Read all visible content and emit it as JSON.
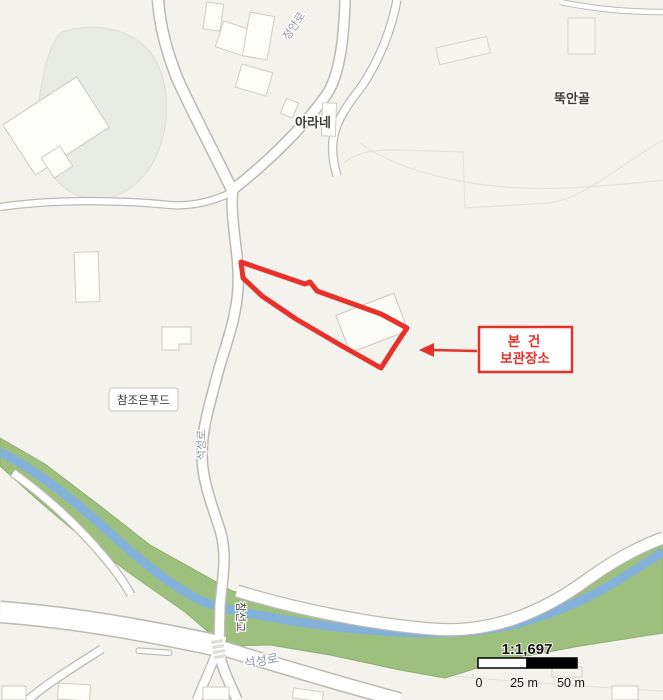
{
  "map": {
    "labels": {
      "road_jeongan": "정안로",
      "village_ddukangol": "뚝안골",
      "poi_arane": "아라네",
      "poi_chamjoeun_food": "참조은푸드",
      "road_seokseong_vertical": "석성로",
      "bridge_chamseon": "참선교",
      "road_seokseong_bottom": "석성로"
    },
    "annotation": {
      "line1": "본 건",
      "line2": "보관장소"
    },
    "scale_bar": {
      "ratio": "1:1,697",
      "ticks": [
        "0",
        "25 m",
        "50 m"
      ]
    },
    "colors": {
      "background": "#f4f2ed",
      "road_fill": "#ffffff",
      "road_casing": "#bcb9b3",
      "greenway": "#9dc07e",
      "river": "#84b1d9",
      "forest": "#e9ece4",
      "annotation_red": "#e8312a",
      "road_label": "#8d94a6",
      "poi_label": "#3c3b36"
    }
  }
}
